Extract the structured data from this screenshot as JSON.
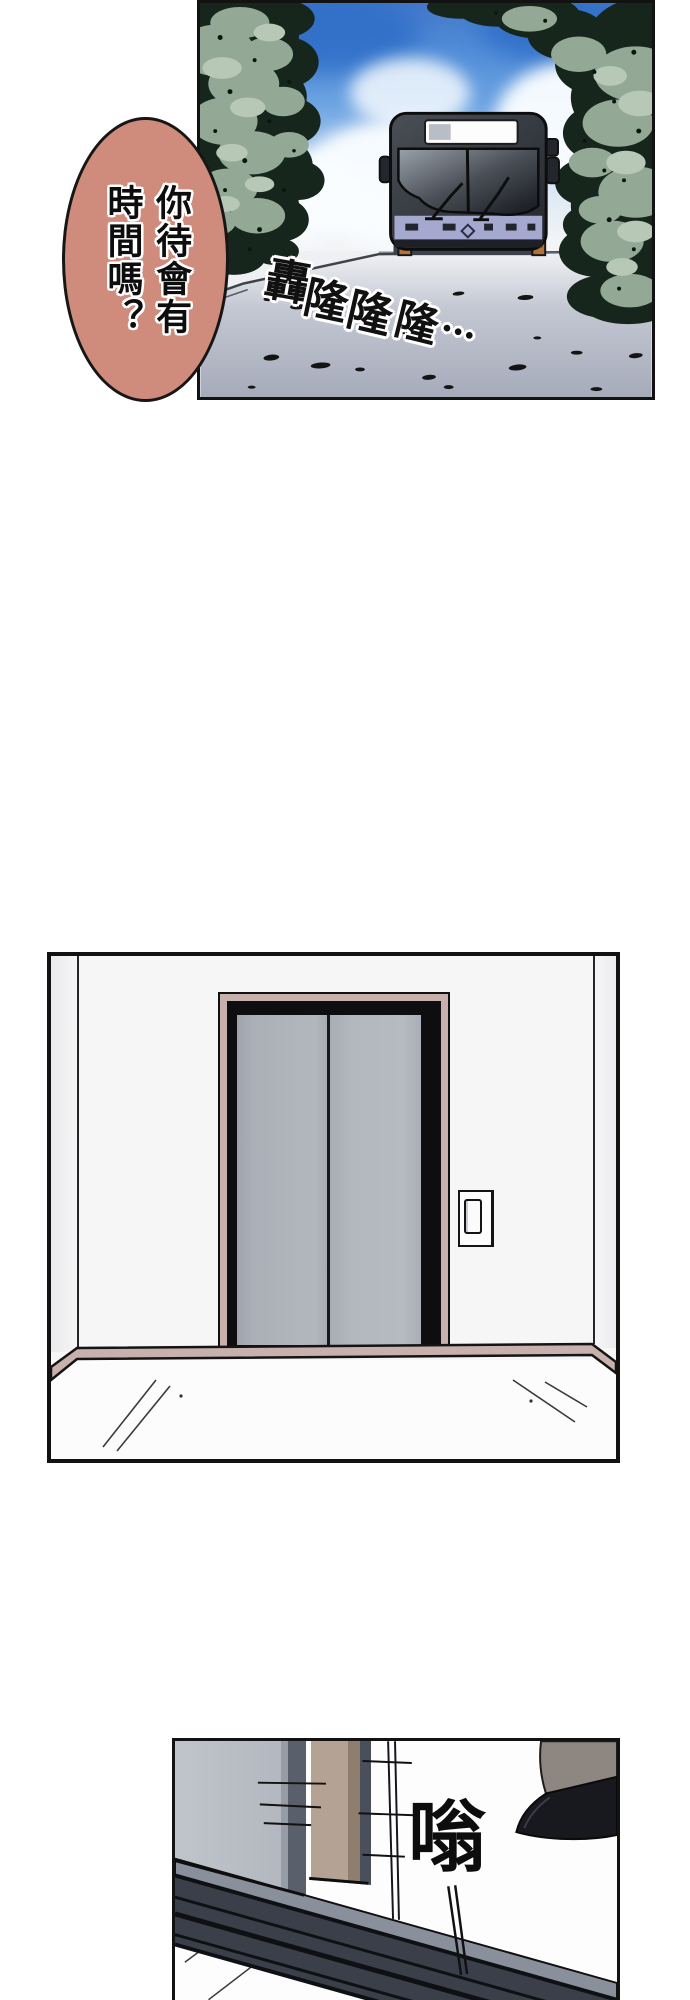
{
  "page": {
    "width": 690,
    "height": 2000
  },
  "colors": {
    "page-bg": "#ffffff",
    "bubble": "#cf8c7c",
    "sky-deep": "#2f6ec8",
    "foliage": "#93a995",
    "foliage-dark": "#17261c",
    "foliage-light": "#b7c8b6",
    "road-gray": "#a9aebc",
    "bus-dark": "#2b2f36",
    "bus-body": "#a5a8cf",
    "wheel-accent": "#b5713a",
    "wall": "#f6f6f7",
    "trim-pink": "#c8b0ac",
    "frame-black": "#0e0e10",
    "p3-door-edge": "#59606c",
    "p3-frame-tan": "#b4a294",
    "p3-frame-tan-dark": "#8f7e6e",
    "p3-strip": "#4a505b",
    "track": "#3a3f49",
    "track-light": "#8a909b",
    "leg": "#8e8781",
    "shoe": "#17191e"
  },
  "bubble": {
    "text": "你待會有\n時間嗎？"
  },
  "panel_bus": {
    "sfx_chars": [
      "轟",
      "隆",
      "隆",
      "隆",
      "…"
    ]
  },
  "panel_door": {
    "sfx": "嗡"
  }
}
